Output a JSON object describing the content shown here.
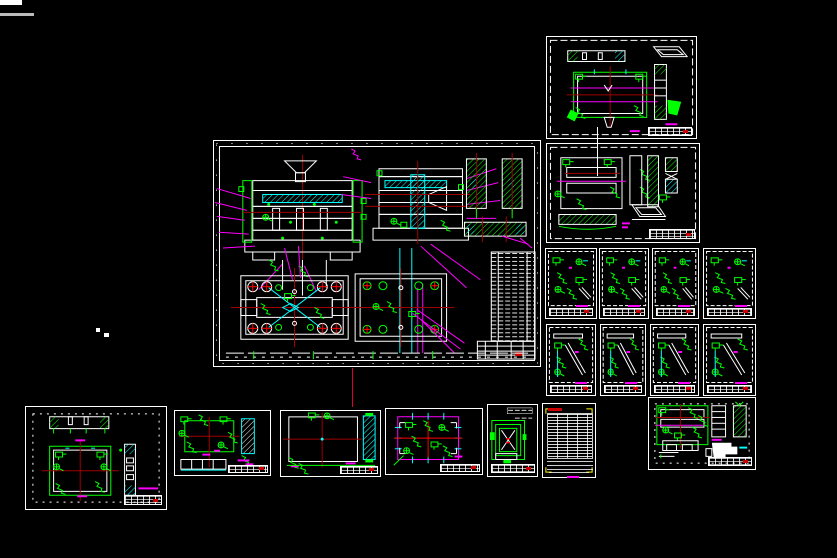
{
  "canvas": {
    "width": 837,
    "height": 558,
    "background": "#000000"
  },
  "palette": {
    "sheet_border": "#ffffff",
    "linework_white": "#ffffff",
    "linework_green": "#00ff00",
    "linework_magenta": "#ff00ff",
    "linework_cyan": "#00ffff",
    "linework_red": "#ff0000",
    "centerline_dark_red": "#a00000",
    "bom_corner_yellow": "#ffff00",
    "stamp_red": "#cc0000"
  },
  "sheets": {
    "center": {
      "x": 213,
      "y": 140,
      "w": 328,
      "h": 227,
      "kind": "mold-assembly-general-drawing"
    },
    "tr": {
      "x": 546,
      "y": 36,
      "w": 151,
      "h": 103,
      "kind": "plate-part-drawing"
    },
    "rm": {
      "x": 546,
      "y": 143,
      "w": 154,
      "h": 100,
      "kind": "plate-part-drawing"
    },
    "a": {
      "x": 25,
      "y": 406,
      "w": 142,
      "h": 104,
      "kind": "plate-part-drawing"
    },
    "b": {
      "x": 174,
      "y": 410,
      "w": 97,
      "h": 66,
      "kind": "plate-part-drawing"
    },
    "c": {
      "x": 280,
      "y": 410,
      "w": 101,
      "h": 67,
      "kind": "plate-part-drawing"
    },
    "d": {
      "x": 385,
      "y": 408,
      "w": 98,
      "h": 67,
      "kind": "plate-part-drawing"
    },
    "e": {
      "x": 487,
      "y": 404,
      "w": 51,
      "h": 73,
      "kind": "bracket-part-drawing"
    },
    "f": {
      "x": 542,
      "y": 403,
      "w": 54,
      "h": 75,
      "kind": "parts-list-table-sheet"
    },
    "g": {
      "x": 648,
      "y": 397,
      "w": 108,
      "h": 73,
      "kind": "plate-part-drawing"
    }
  },
  "small_sheets": [
    {
      "x": 545,
      "y": 248,
      "w": 52,
      "h": 71,
      "variant": "small-scatter",
      "kind": "detail-parts-sheet"
    },
    {
      "x": 599,
      "y": 248,
      "w": 50,
      "h": 71,
      "variant": "small-scatter",
      "kind": "detail-parts-sheet"
    },
    {
      "x": 652,
      "y": 248,
      "w": 47,
      "h": 71,
      "variant": "small-scatter",
      "kind": "detail-parts-sheet"
    },
    {
      "x": 703,
      "y": 248,
      "w": 53,
      "h": 71,
      "variant": "small-scatter",
      "kind": "detail-parts-sheet"
    },
    {
      "x": 546,
      "y": 324,
      "w": 50,
      "h": 72,
      "variant": "small-pin",
      "kind": "pin-detail-sheet"
    },
    {
      "x": 600,
      "y": 324,
      "w": 46,
      "h": 72,
      "variant": "small-pin",
      "kind": "pin-detail-sheet"
    },
    {
      "x": 650,
      "y": 324,
      "w": 49,
      "h": 72,
      "variant": "small-pin",
      "kind": "pin-detail-sheet"
    },
    {
      "x": 703,
      "y": 324,
      "w": 53,
      "h": 72,
      "variant": "small-pin",
      "kind": "pin-detail-sheet"
    }
  ],
  "artifacts": {
    "red_connector_line": {
      "x": 352,
      "y": 368,
      "h": 39,
      "color": "#dd0033"
    },
    "white_connector_line": {
      "x": 597,
      "y": 127,
      "h": 49,
      "color": "#ffffff"
    },
    "corner_fragment_bar": {
      "x": 0,
      "y": 0,
      "w": 22,
      "h": 5
    },
    "corner_fragment_text": {
      "x": 0,
      "y": 13,
      "w": 34,
      "h": 3
    },
    "stray_dots": [
      {
        "x": 96,
        "y": 328,
        "w": 4,
        "h": 4
      },
      {
        "x": 104,
        "y": 333,
        "w": 5,
        "h": 4
      }
    ]
  }
}
